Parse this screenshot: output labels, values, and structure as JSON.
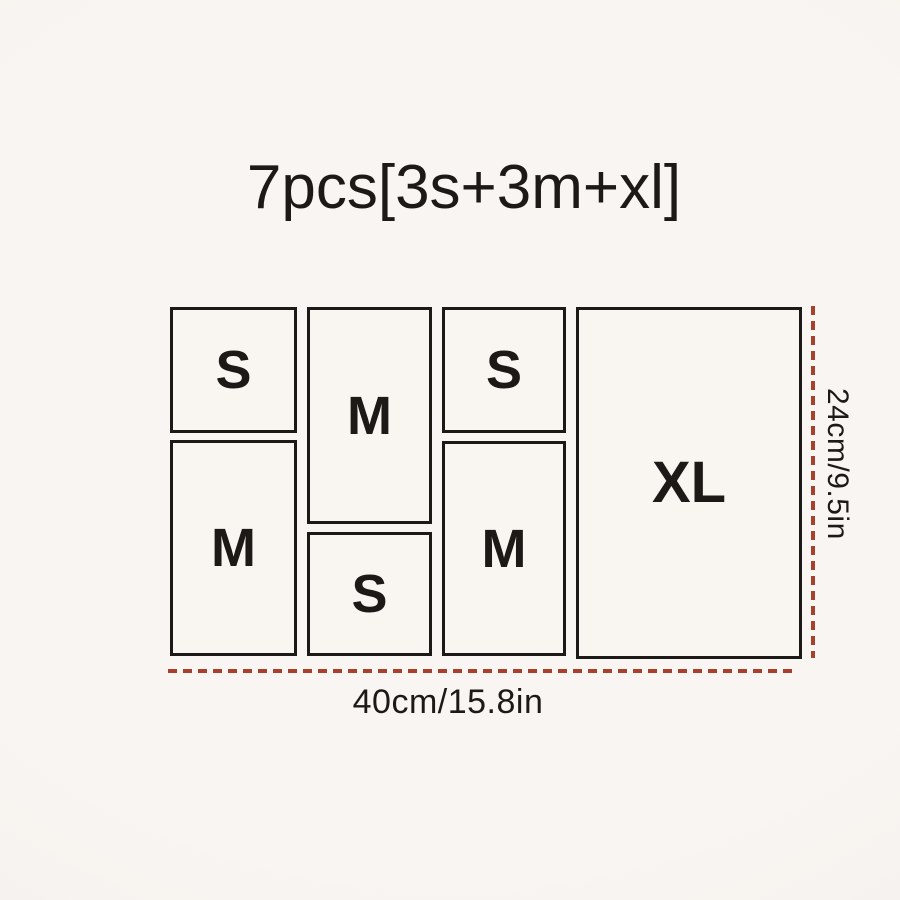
{
  "theme": {
    "bg": "#f9f5f2",
    "bg-edge": "#f1ede9",
    "ink": "#1c1917",
    "box-fill": "#f9f6f2",
    "dim": "#a7402c"
  },
  "title": "7pcs[3s+3m+xl]",
  "diagram": {
    "boxes": [
      {
        "id": "s-top-left",
        "label": "S"
      },
      {
        "id": "m-top-middle",
        "label": "M"
      },
      {
        "id": "s-top-right",
        "label": "S"
      },
      {
        "id": "m-bottom-left",
        "label": "M"
      },
      {
        "id": "s-bottom-middle",
        "label": "S"
      },
      {
        "id": "m-bottom-right",
        "label": "M"
      },
      {
        "id": "xl-right",
        "label": "XL"
      }
    ],
    "dimensions": {
      "width_label": "40cm/15.8in",
      "height_label": "24cm/9.5in"
    }
  }
}
